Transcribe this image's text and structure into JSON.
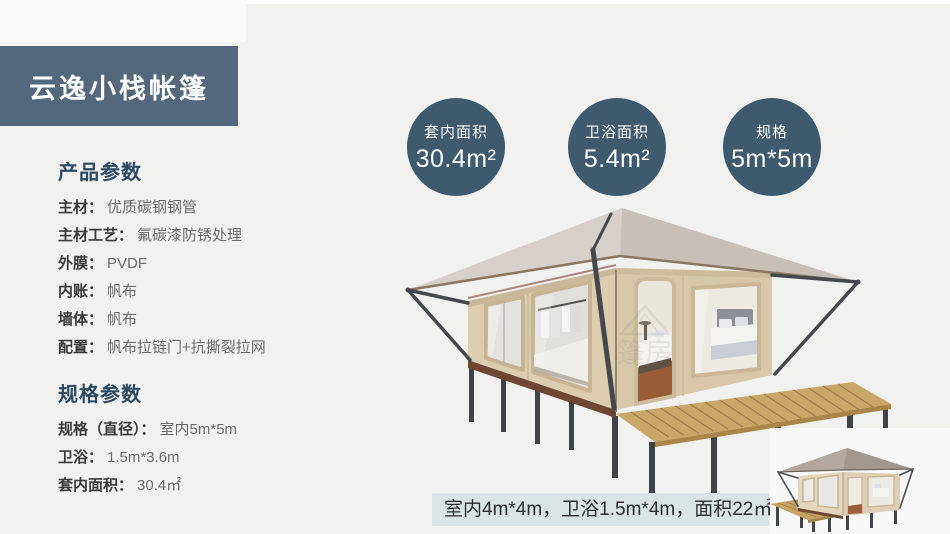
{
  "header": {
    "title": "云逸小栈帐篷"
  },
  "product_params": {
    "heading": "产品参数",
    "items": [
      {
        "label": "主材：",
        "value": "优质碳钢钢管"
      },
      {
        "label": "主材工艺：",
        "value": "氟碳漆防锈处理"
      },
      {
        "label": "外膜：",
        "value": "PVDF"
      },
      {
        "label": "内账：",
        "value": "帆布"
      },
      {
        "label": "墙体：",
        "value": "帆布"
      },
      {
        "label": "配置：",
        "value": "帆布拉链门+抗撕裂拉网"
      }
    ]
  },
  "spec_params": {
    "heading": "规格参数",
    "items": [
      {
        "label": "规格（直径）：",
        "value": "室内5m*5m"
      },
      {
        "label": "卫浴：",
        "value": "1.5m*3.6m"
      },
      {
        "label": "套内面积：",
        "value": "30.4㎡"
      }
    ]
  },
  "stat_circles": [
    {
      "label": "套内面积",
      "value": "30.4m²"
    },
    {
      "label": "卫浴面积",
      "value": "5.4m²"
    },
    {
      "label": "规格",
      "value": "5m*5m"
    }
  ],
  "caption": {
    "text": "室内4m*4m，卫浴1.5m*4m，面积22㎡"
  },
  "watermark": {
    "text": "篷房"
  },
  "colors": {
    "banner": "#53687c",
    "circle": "#3d5a6f",
    "heading": "#2c4a63",
    "caption_bg": "#d9e4e7",
    "background": "#f1f1f0"
  }
}
